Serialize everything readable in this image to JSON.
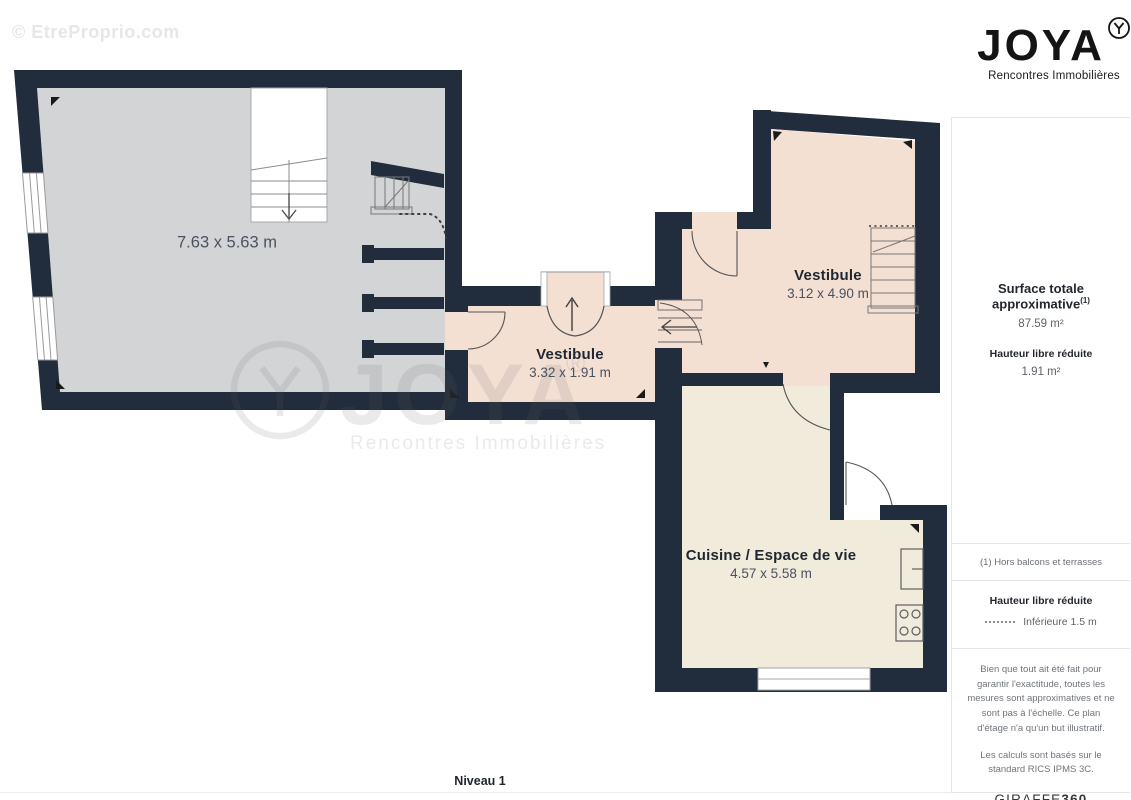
{
  "watermark_top": "© EtreProprio.com",
  "logo": {
    "name": "JOYA",
    "tagline": "Rencontres Immobilières"
  },
  "sidebar": {
    "surface_title": "Surface totale approximative",
    "surface_sup": "(1)",
    "surface_value": "87.59 m²",
    "height_title": "Hauteur libre réduite",
    "height_value": "1.91 m²",
    "footnote": "(1) Hors balcons et terrasses",
    "legend_title": "Hauteur libre réduite",
    "legend_item": "Inférieure 1.5 m",
    "disclaimer1": "Bien que tout ait été fait pour garantir l'exactitude, toutes les mesures sont approximatives et ne sont pas à l'échelle. Ce plan d'étage n'a qu'un but illustratif.",
    "disclaimer2": "Les calculs sont basés sur le standard RICS IPMS 3C.",
    "brand_name": "GIRAFFE",
    "brand_suffix": "360"
  },
  "plan": {
    "level_label": "Niveau 1",
    "rooms": {
      "living": {
        "dims": "7.63 x 5.63 m"
      },
      "vest_center": {
        "name": "Vestibule",
        "dims": "3.32 x 1.91 m"
      },
      "vest_right": {
        "name": "Vestibule",
        "dims": "3.12 x 4.90 m"
      },
      "kitchen": {
        "name": "Cuisine / Espace de vie",
        "dims": "4.57 x 5.58 m"
      }
    },
    "watermark_center": {
      "brand": "JOYA",
      "reg": "®",
      "tagline": "Rencontres Immobilières"
    }
  },
  "colors": {
    "wall": "#212d3c",
    "room_gray": "#d3d4d6",
    "room_pink": "#f4dfd3",
    "room_cream": "#f0ebdb",
    "line": "#707070"
  }
}
